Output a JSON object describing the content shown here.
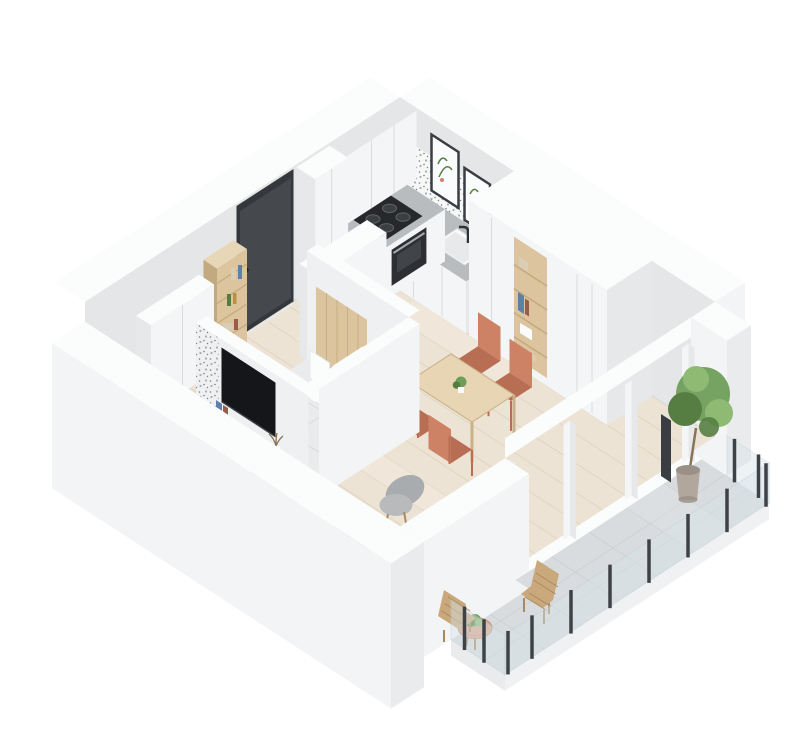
{
  "scene": {
    "title": "3D apartment floor plan render",
    "description": "Isometric 3D cutaway floor plan of a small studio apartment on a white background: white kitchen with cooktop, oven and sink along the back walls, framed wall art, dark entrance door, wood open shelf and storage cabinets in the hall, bathroom with wall-hung toilet, washing machine and bathtub, TV on a sage-green media console, white sofa with gray and terracotta pillows, round coffee tables, gray armchair, light wood dining table with four terracotta chairs, tall white wardrobe with open wood shelves, and a tiled balcony with glass railing, wooden outdoor chairs, round table and a potted tree.",
    "background": "#ffffff"
  },
  "palette": {
    "bg": "#ffffff",
    "wallFace": "#e4e6e7",
    "wallInner": "#eff0f1",
    "wallTop": "#fbfcfc",
    "wallOuter": "#f3f4f5",
    "wallOuterDark": "#e9ebec",
    "floorWood": "#ece3d4",
    "plankLine": "#dbd0be",
    "plankLight": "#f4ecdf",
    "rug": "#f0ebe1",
    "tile": "#d9dcde",
    "tileLine": "#c7cbce",
    "tileLight": "#e3e5e7",
    "fascia": "#eff1f2",
    "bathFloor": "#eaebec",
    "cabinet": "#f4f5f6",
    "cabinetShade": "#e6e8ea",
    "seamLine": "#d8dbdd",
    "counterTop": "#b9bcbf",
    "cooktop": "#26282b",
    "burner": "#3c3f42",
    "burnerRing": "#606468",
    "oven": "#2d2f32",
    "ovenGlass": "#45484c",
    "steel": "#a6aaae",
    "sink": "#fafbfc",
    "sinkInner": "#e4e7e9",
    "faucet": "#2f3235",
    "terrBg": "#f6f7f7",
    "terrDot1": "#a7adb2",
    "terrDot2": "#787e83",
    "door": "#45494e",
    "doorDark": "#34373b",
    "handle": "#222426",
    "wood": "#dcc49e",
    "woodDark": "#c3a97f",
    "woodLight": "#e7d7b7",
    "shelfItemBlue": "#5d7fa8",
    "shelfItemRed": "#9c5a4c",
    "shelfItemGreen": "#5a7a3f",
    "shelfItemAmber": "#bd8f43",
    "shelfItemBeige": "#d9cdb6",
    "table": "#e7d5b4",
    "tableEdge": "#cab088",
    "chair": "#ce8265",
    "chairDark": "#b76e53",
    "sofa": "#f1f1ee",
    "sofaTop": "#f6f6f3",
    "sofaShade": "#e3e3df",
    "pillowGray": "#b5b7b9",
    "pillowCoral": "#c98063",
    "armchairBack": "#a9acae",
    "armchairSeat": "#b8babc",
    "coffeeTop": "#ede6d5",
    "coffeeSide": "#dcd3bf",
    "console": "#b4c5af",
    "consoleSide": "#a3b59e",
    "consoleWood": "#dac29c",
    "tv": "#141619",
    "tvEdge": "#3a3d41",
    "whiteFix": "#fbfcfc",
    "whiteFixShade": "#e6e9eb",
    "washerDoor": "#3b3e42",
    "washerRing": "#c9cbcd",
    "plant": "#6f9e5a",
    "plantDark": "#567e42",
    "plantLight": "#8fba74",
    "pot": "#b1a79d",
    "potDark": "#9a9087",
    "trunk": "#8a7355",
    "post": "#3e4246",
    "glass": "#d8e4ea",
    "glassEdge": "#c2ced4",
    "balWood": "#c9a87b",
    "balWoodDark": "#a98a60",
    "balTable": "#d9a98b",
    "balTableEdge": "#c29176",
    "heater": "#3a3e42",
    "aoLine": "#d5d7d8"
  },
  "rooms": {
    "kitchen": {
      "items": [
        "upper-cabinets",
        "tall-pantry",
        "induction-cooktop",
        "built-in-oven",
        "l-shaped-counter",
        "kitchen-sink",
        "terrazzo-backsplash",
        "wall-art-prints",
        "counter-plant"
      ]
    },
    "hall": {
      "items": [
        "entrance-door",
        "open-shelf-unit",
        "storage-cabinet"
      ]
    },
    "bathroom": {
      "items": [
        "wall-hung-toilet",
        "washing-machine",
        "bathtub",
        "wood-accent-wall"
      ]
    },
    "dining": {
      "items": [
        "wood-dining-table",
        "terracotta-chair-1",
        "terracotta-chair-2",
        "terracotta-chair-3",
        "terracotta-chair-4",
        "table-plant"
      ]
    },
    "living": {
      "items": [
        "tv",
        "media-console",
        "decor-vase",
        "sofa",
        "throw-pillows",
        "armchair",
        "nesting-coffee-tables",
        "rug"
      ]
    },
    "wardrobe": {
      "items": [
        "wardrobe-wall-unit",
        "open-shelves"
      ]
    },
    "balcony": {
      "items": [
        "tile-floor",
        "glass-railing",
        "potted-tree",
        "outdoor-chair-1",
        "outdoor-chair-2",
        "outdoor-table",
        "outdoor-heater"
      ]
    }
  }
}
